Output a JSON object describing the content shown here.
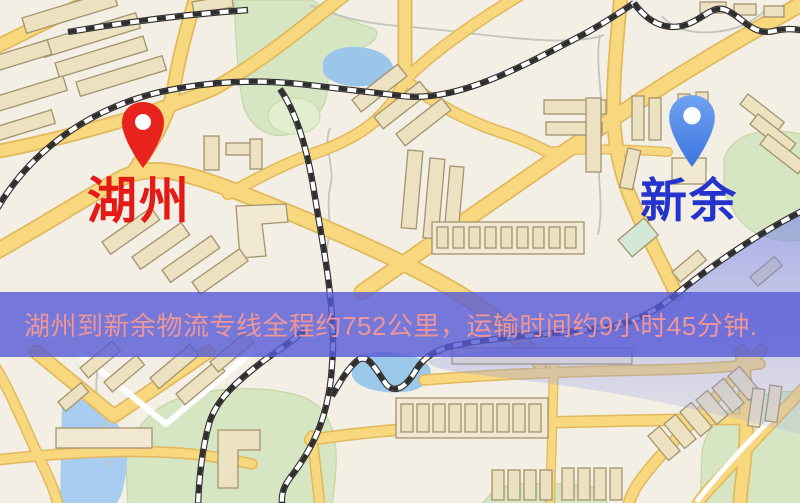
{
  "map": {
    "origin": {
      "label": "湖州",
      "pin_color": "#e8221c",
      "label_color": "#e51a16"
    },
    "destination": {
      "label": "新余",
      "pin_color": "#4e8bee",
      "label_color": "#2433cb"
    }
  },
  "banner": {
    "text": "湖州到新余物流专线全程约752公里，运输时间约9小时45分钟.",
    "background": "#585cd7",
    "text_color": "#ee9597"
  },
  "route_facts": {
    "distance_km": "752",
    "duration": "9小时45分钟"
  },
  "palette": {
    "map_background": "#f4efe4",
    "road_yellow": "#f8d87e",
    "road_casing": "#e2b85c",
    "building_fill": "#ece1c0",
    "green_area": "#d7e6c2",
    "water": "#a9cdf0",
    "water_wash": "#8e9ce4",
    "railway_dark": "#2e2e2e"
  }
}
